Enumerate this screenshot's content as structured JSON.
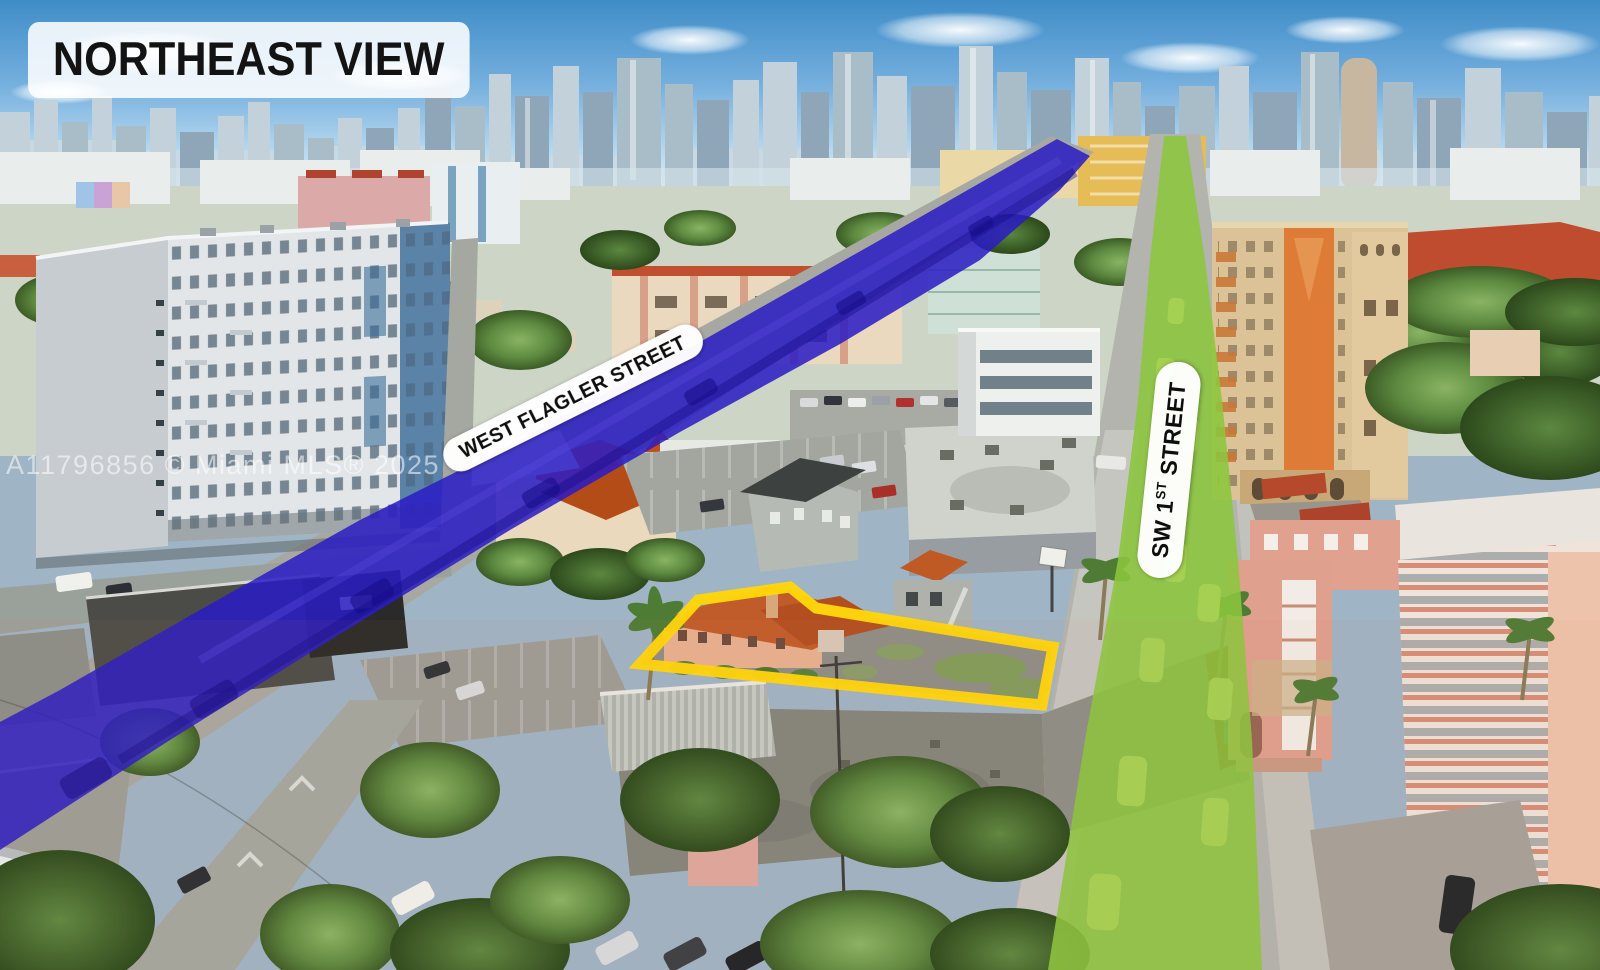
{
  "annotations": {
    "view_badge": "NORTHEAST VIEW",
    "watermark": "A11796856 © Miami MLS® 2025"
  },
  "streets": {
    "flagler": {
      "label": "WEST FLAGLER STREET",
      "highlight_color": "#2a1cc4"
    },
    "sw_1st": {
      "label_prefix": "SW 1",
      "label_ordinal": "ST",
      "label_suffix": " STREET",
      "highlight_color": "#8cc63e"
    }
  },
  "property": {
    "outline_color": "#ffd60a"
  }
}
